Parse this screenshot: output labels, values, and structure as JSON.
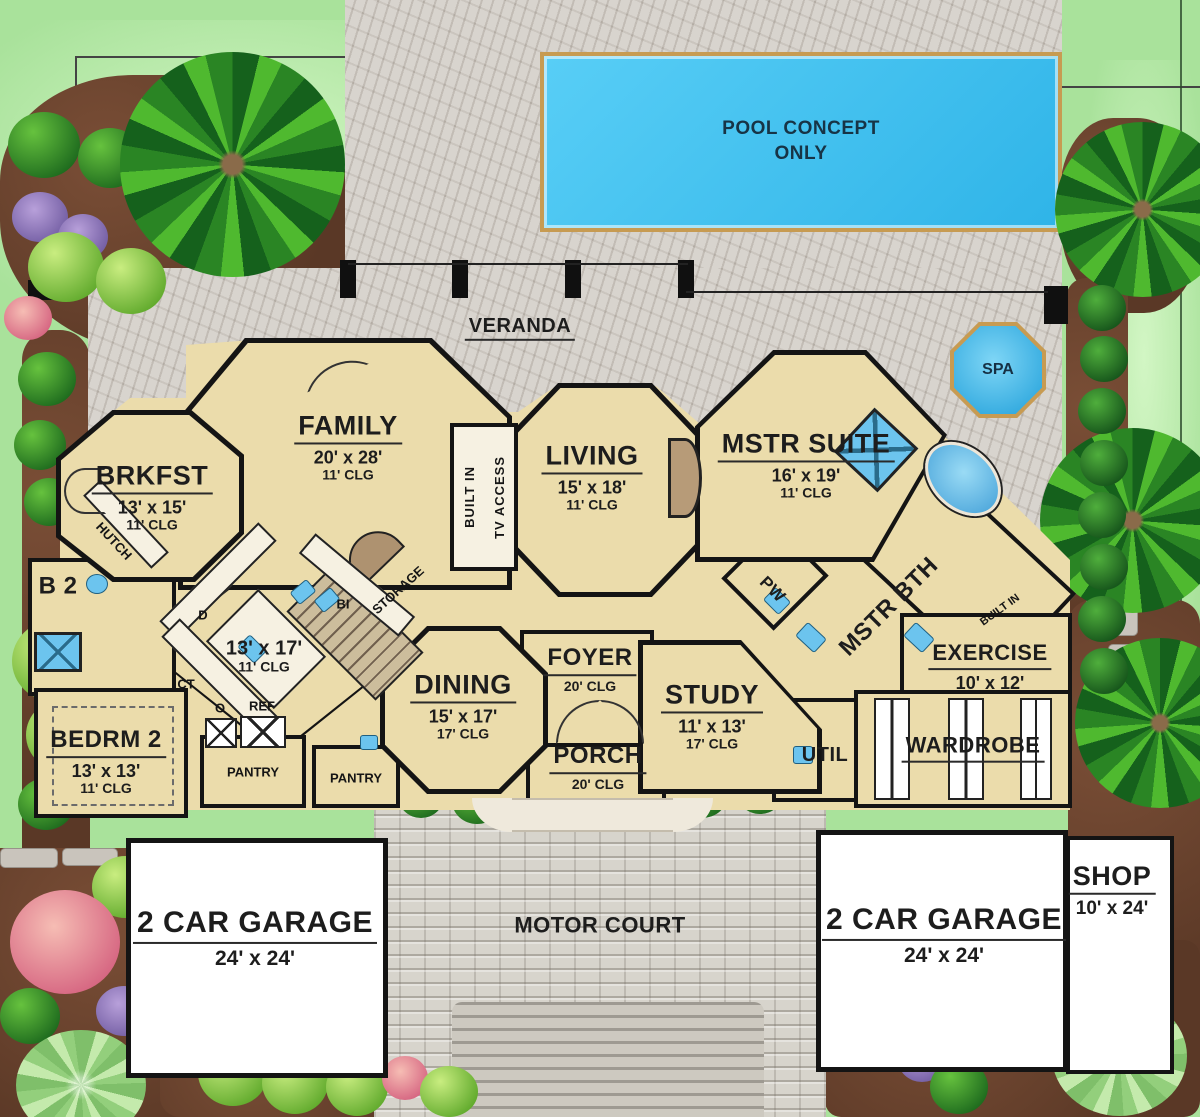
{
  "outdoor": {
    "pool_line1": "POOL CONCEPT",
    "pool_line2": "ONLY",
    "veranda": "VERANDA",
    "spa": "SPA",
    "motor_court": "MOTOR COURT"
  },
  "rooms": {
    "family": {
      "name": "FAMILY",
      "dims": "20' x 28'",
      "clg": "11' CLG"
    },
    "brkfst": {
      "name": "BRKFST",
      "dims": "13' x 15'",
      "clg": "11' CLG"
    },
    "living": {
      "name": "LIVING",
      "dims": "15' x 18'",
      "clg": "11' CLG"
    },
    "mstr_suite": {
      "name": "MSTR SUITE",
      "dims": "16' x 19'",
      "clg": "11' CLG"
    },
    "kitchen": {
      "dims": "13' x 17'",
      "clg": "11' CLG"
    },
    "dining": {
      "name": "DINING",
      "dims": "15' x 17'",
      "clg": "17' CLG"
    },
    "foyer": {
      "name": "FOYER",
      "clg": "20' CLG"
    },
    "porch": {
      "name": "PORCH",
      "clg": "20' CLG"
    },
    "study": {
      "name": "STUDY",
      "dims": "11' x 13'",
      "clg": "17' CLG"
    },
    "bedrm2": {
      "name": "BEDRM 2",
      "dims": "13' x 13'",
      "clg": "11' CLG"
    },
    "b2": {
      "name": "B 2"
    },
    "exercise": {
      "name": "EXERCISE",
      "dims": "10' x 12'"
    },
    "wardrobe": {
      "name": "WARDROBE"
    },
    "mstr_bth": {
      "name": "MSTR BTH"
    },
    "util": {
      "name": "UTIL"
    },
    "pw": {
      "name": "PW"
    },
    "garage_left": {
      "name": "2 CAR GARAGE",
      "dims": "24' x 24'"
    },
    "garage_right": {
      "name": "2 CAR GARAGE",
      "dims": "24' x 24'"
    },
    "shop": {
      "name": "SHOP",
      "dims": "10' x 24'"
    }
  },
  "annotations": {
    "hutch": "HUTCH",
    "storage": "STORAGE",
    "bi": "BI",
    "built_in_tv": "BUILT IN",
    "tv_access": "TV ACCESS",
    "built_in_mstr": "BUILT IN",
    "d": "D",
    "ct": "CT",
    "o": "O",
    "ref": "REF",
    "pantry_1": "PANTRY",
    "pantry_2": "PANTRY"
  },
  "colors": {
    "room_tan": "#EBDCAB",
    "wall_black": "#141414",
    "pool_blue": "#42C3F2",
    "fixture_blue": "#6CC4EE",
    "stone_gray": "#CBC5BD",
    "paver_gray": "#D7D4CC",
    "lawn_green": "#A9E29B",
    "mulch_brown": "#6B422F"
  }
}
